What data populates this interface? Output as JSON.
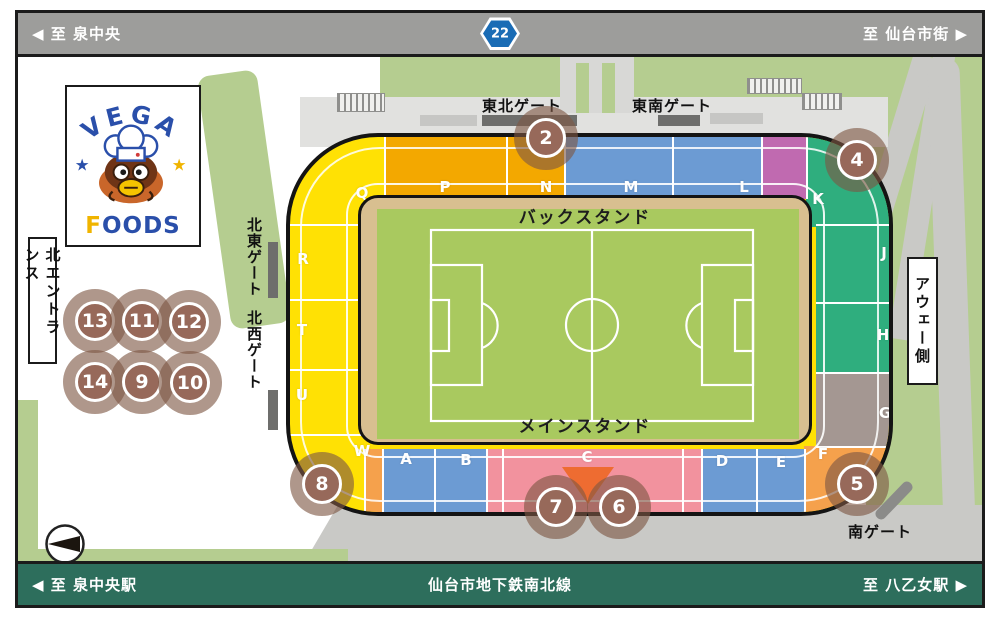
{
  "top_bar": {
    "left": "◀ 至 泉中央",
    "route_badge": "22",
    "right": "至 仙台市街 ▶"
  },
  "bottom_bar": {
    "left": "◀ 至 泉中央駅",
    "center": "仙台市地下鉄南北線",
    "right": "至 八乙女駅 ▶"
  },
  "logo": {
    "title": "VEGA",
    "foods_f": "F",
    "foods_rest": "OODS"
  },
  "labels": {
    "back_stand": "バックスタンド",
    "main_stand": "メインスタンド",
    "north_entrance": "北エントランス",
    "away_side": "アウェー側"
  },
  "gates": {
    "northeast": "東北ゲート",
    "southeast": "東南ゲート",
    "north_east_side": "北東ゲート",
    "north_west_side": "北西ゲート",
    "south": "南ゲート"
  },
  "sections": [
    {
      "letter": "Q"
    },
    {
      "letter": "P"
    },
    {
      "letter": "N"
    },
    {
      "letter": "M"
    },
    {
      "letter": "L"
    },
    {
      "letter": "K"
    },
    {
      "letter": "J"
    },
    {
      "letter": "H"
    },
    {
      "letter": "G"
    },
    {
      "letter": "F"
    },
    {
      "letter": "E"
    },
    {
      "letter": "D"
    },
    {
      "letter": "C"
    },
    {
      "letter": "B"
    },
    {
      "letter": "A"
    },
    {
      "letter": "W"
    },
    {
      "letter": "U"
    },
    {
      "letter": "T"
    },
    {
      "letter": "R"
    }
  ],
  "booths": [
    {
      "number": "2"
    },
    {
      "number": "4"
    },
    {
      "number": "13"
    },
    {
      "number": "11"
    },
    {
      "number": "12"
    },
    {
      "number": "14"
    },
    {
      "number": "9"
    },
    {
      "number": "10"
    },
    {
      "number": "8"
    },
    {
      "number": "7"
    },
    {
      "number": "6"
    },
    {
      "number": "5"
    }
  ],
  "colors": {
    "bar_gray": "#9d9d9b",
    "bar_green": "#2d6e5c",
    "route_badge_blue": "#1a6cb5",
    "stand_yellow": "#ffe104",
    "stand_gold": "#f3a800",
    "stand_blue": "#6c9bd3",
    "stand_purple": "#c06ab0",
    "stand_green": "#2fae7e",
    "stand_taupe": "#a49792",
    "stand_pink": "#f2929e",
    "stand_orange": "#f5a14c",
    "booth_brown": "#97695a",
    "pitch_tan": "#d8bf90",
    "field_green": "#a9c95f",
    "grass_green": "#b5cd90",
    "road_gray": "#c9c9c6"
  }
}
